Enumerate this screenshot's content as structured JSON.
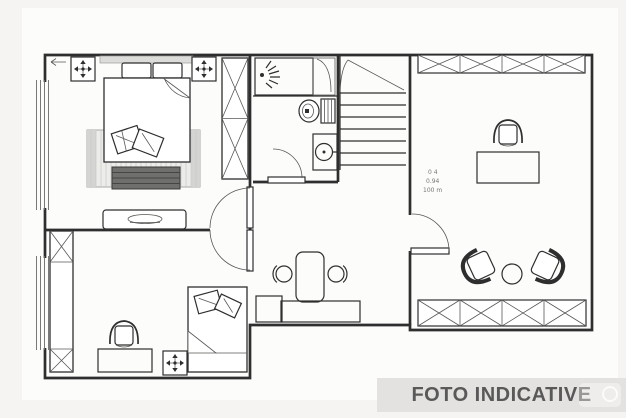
{
  "watermark": {
    "label": "FOTO INDICATIVE",
    "background": "#e4e2e1",
    "text_color": "#595959"
  },
  "annotation": {
    "line1": "0 4",
    "line2": "0.94",
    "line3": "100 m"
  },
  "colors": {
    "line": "#2e2e2e",
    "page_background": "#f5f4f3",
    "paper": "#fcfcfb",
    "rug": "#ececea",
    "bench": "#6f6f6d"
  },
  "icons": {
    "ceiling_light": "four-way-arrow-in-square",
    "shower_head": "spray-fan",
    "toilet": "toilet-top-view",
    "sink": "round-basin-with-tap",
    "staircase": "tread-lines-with-break-line",
    "wardrobe": "x-crossed-cabinet"
  }
}
